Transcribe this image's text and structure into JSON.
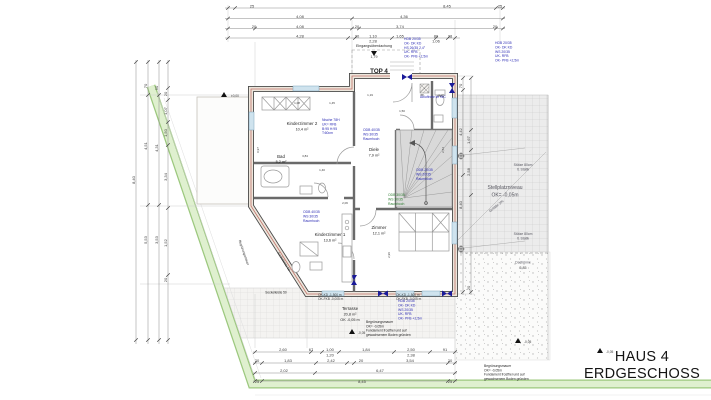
{
  "title_block": {
    "line1": "HAUS 4",
    "line2": "ERDGESCHOSS"
  },
  "colors": {
    "dim": "#3c3c3c",
    "room": "#1f1f1f",
    "muted": "#55555e",
    "blue": "#2b2bb4",
    "green": "#2e7d32",
    "boundary": "#8fbf77",
    "boundary_fill": "#dff0cf",
    "wall": "#4a4a4a",
    "wall_fill": "#ece6dc",
    "wall_accent": "#c0736a",
    "window": "#cfe3ee",
    "marker_blue": "#1a1a99"
  },
  "annotations": {
    "labels": [
      {
        "t": "25",
        "x": 252,
        "y": 7.5
      },
      {
        "t": "8,45",
        "x": 447,
        "y": 7.5
      },
      {
        "t": "25",
        "x": 500,
        "y": 7.5
      },
      {
        "t": "4,08",
        "x": 300,
        "y": 18
      },
      {
        "t": "4,36",
        "x": 404,
        "y": 18
      },
      {
        "t": "20",
        "x": 254,
        "y": 28
      },
      {
        "t": "4,08",
        "x": 300,
        "y": 28
      },
      {
        "t": "20",
        "x": 357,
        "y": 28
      },
      {
        "t": "3,74",
        "x": 400,
        "y": 28
      },
      {
        "t": "20",
        "x": 495,
        "y": 28
      },
      {
        "t": "4,28",
        "x": 300,
        "y": 37.5
      },
      {
        "t": "20",
        "x": 357,
        "y": 37.5
      },
      {
        "t": "1,10",
        "x": 373,
        "y": 37.5
      },
      {
        "t": "1,65",
        "x": 400,
        "y": 37.5
      },
      {
        "t": "80",
        "x": 436,
        "y": 37.5
      },
      {
        "t": "28",
        "x": 450,
        "y": 37.5
      },
      {
        "t": "2,28",
        "x": 373,
        "y": 42.5
      },
      {
        "t": "1,06",
        "x": 436,
        "y": 42.5
      },
      {
        "t": "Eingangsüberdachung",
        "x": 374,
        "y": 47,
        "s": 3.6,
        "c": "room"
      },
      {
        "t": "1,79",
        "x": 374,
        "y": 58,
        "s": 3.6
      },
      {
        "t": "8,40",
        "x": 135,
        "y": 180,
        "r": -90
      },
      {
        "t": "70",
        "x": 147,
        "y": 86,
        "r": -90
      },
      {
        "t": "4,51",
        "x": 147,
        "y": 146,
        "r": -90
      },
      {
        "t": "5,53",
        "x": 147,
        "y": 240,
        "r": -90
      },
      {
        "t": "50",
        "x": 158,
        "y": 88,
        "r": -90
      },
      {
        "t": "4,31",
        "x": 158,
        "y": 148,
        "r": -90
      },
      {
        "t": "3,53",
        "x": 158,
        "y": 240,
        "r": -90
      },
      {
        "t": "20",
        "x": 167,
        "y": 94,
        "r": -90
      },
      {
        "t": "1,07",
        "x": 167,
        "y": 111,
        "r": -90
      },
      {
        "t": "1,50",
        "x": 167,
        "y": 133,
        "r": -90
      },
      {
        "t": "3,34",
        "x": 167,
        "y": 177,
        "r": -90
      },
      {
        "t": "1,52",
        "x": 167,
        "y": 243,
        "r": -90
      },
      {
        "t": "20",
        "x": 167,
        "y": 280,
        "r": -90
      },
      {
        "t": "70",
        "x": 462,
        "y": 86,
        "r": -90
      },
      {
        "t": "4,42",
        "x": 462,
        "y": 132,
        "r": -90
      },
      {
        "t": "8,40",
        "x": 462,
        "y": 205,
        "r": -90
      },
      {
        "t": "1,67",
        "x": 470,
        "y": 140,
        "r": -90
      },
      {
        "t": "2,58",
        "x": 470,
        "y": 172,
        "r": -90
      },
      {
        "t": "20",
        "x": 470,
        "y": 288,
        "r": -90
      },
      {
        "t": "2,60",
        "x": 283,
        "y": 351
      },
      {
        "t": "67",
        "x": 311,
        "y": 351
      },
      {
        "t": "1,00",
        "x": 330,
        "y": 351
      },
      {
        "t": "1,84",
        "x": 366,
        "y": 351
      },
      {
        "t": "2,50",
        "x": 411,
        "y": 351
      },
      {
        "t": "91",
        "x": 445,
        "y": 351
      },
      {
        "t": "1,20",
        "x": 330,
        "y": 356.5
      },
      {
        "t": "2,38",
        "x": 411,
        "y": 356.5
      },
      {
        "t": "20",
        "x": 257,
        "y": 362
      },
      {
        "t": "1,83",
        "x": 288,
        "y": 362
      },
      {
        "t": "2,42",
        "x": 331,
        "y": 362
      },
      {
        "t": "20",
        "x": 361,
        "y": 362
      },
      {
        "t": "3,54",
        "x": 410,
        "y": 362
      },
      {
        "t": "20",
        "x": 450,
        "y": 362
      },
      {
        "t": "2,02",
        "x": 284,
        "y": 372
      },
      {
        "t": "6,47",
        "x": 380,
        "y": 372
      },
      {
        "t": "25",
        "x": 257,
        "y": 383
      },
      {
        "t": "8,45",
        "x": 362,
        "y": 383
      },
      {
        "t": "25",
        "x": 450,
        "y": 383
      },
      {
        "t": "5,85",
        "x": 523,
        "y": 269,
        "s": 3.6
      },
      {
        "t": "TOP 4",
        "x": 379,
        "y": 73,
        "s": 6.2,
        "b": 1,
        "c": "room"
      },
      {
        "t": "Kinderzimmer 2",
        "x": 302,
        "y": 125,
        "s": 4.4,
        "c": "room"
      },
      {
        "t": "10,4 m²",
        "x": 302,
        "y": 130.5,
        "s": 3.8,
        "c": "room"
      },
      {
        "t": "Bad",
        "x": 281,
        "y": 158,
        "s": 4.4,
        "c": "room"
      },
      {
        "t": "5,2 m²",
        "x": 281,
        "y": 163,
        "s": 3.8,
        "c": "room"
      },
      {
        "t": "Kinderzimmer 1",
        "x": 330,
        "y": 236,
        "s": 4.4,
        "c": "room"
      },
      {
        "t": "13,6 m²",
        "x": 330,
        "y": 241.5,
        "s": 3.8,
        "c": "room"
      },
      {
        "t": "Diele",
        "x": 374,
        "y": 151,
        "s": 4.4,
        "c": "room"
      },
      {
        "t": "7,9 m²",
        "x": 374,
        "y": 156.5,
        "s": 3.8,
        "c": "room"
      },
      {
        "t": "Zimmer",
        "x": 379,
        "y": 229,
        "s": 4.4,
        "c": "room"
      },
      {
        "t": "12,1 m²",
        "x": 379,
        "y": 234.5,
        "s": 3.8,
        "c": "room"
      },
      {
        "t": "WC",
        "x": 441,
        "y": 97,
        "s": 3.8,
        "c": "room"
      },
      {
        "t": "Terrasse",
        "x": 350,
        "y": 310,
        "s": 4.2,
        "c": "room"
      },
      {
        "t": "20,8 m²",
        "x": 350,
        "y": 315.5,
        "s": 3.8,
        "c": "room"
      },
      {
        "t": "OK -0,05 m",
        "x": 350,
        "y": 321,
        "s": 3.8,
        "c": "room"
      },
      {
        "t": "Stellplatzniveau",
        "x": 505,
        "y": 189,
        "s": 5,
        "c": "muted"
      },
      {
        "t": "OK= -0,05m",
        "x": 505,
        "y": 196.5,
        "s": 5,
        "c": "muted"
      },
      {
        "t": "Stütze 80cm",
        "x": 523,
        "y": 166,
        "s": 3.4,
        "c": "muted"
      },
      {
        "t": "lt. Statik",
        "x": 523,
        "y": 170.5,
        "s": 3.4,
        "c": "muted"
      },
      {
        "t": "Stütze 80cm",
        "x": 523,
        "y": 235,
        "s": 3.4,
        "c": "muted"
      },
      {
        "t": "lt. Statik",
        "x": 523,
        "y": 239.5,
        "s": 3.4,
        "c": "muted"
      },
      {
        "t": "Dachrinne",
        "x": 523,
        "y": 263.5,
        "s": 3.4,
        "c": "muted"
      },
      {
        "t": "Gefälle 2%",
        "x": 497,
        "y": 207,
        "s": 3.6,
        "r": -38,
        "c": "muted"
      },
      {
        "t": "Sockelleiste 50",
        "x": 276,
        "y": 293.5,
        "s": 3.2,
        "c": "room"
      },
      {
        "t": "Sockelleiste 50",
        "x": 283,
        "y": 262,
        "s": 3.2,
        "r": 58,
        "c": "room"
      },
      {
        "t": "Begrünungsmauer",
        "x": 243,
        "y": 253,
        "s": 3.2,
        "r": 71,
        "c": "room"
      },
      {
        "t": "±0,00",
        "x": 231,
        "y": 97,
        "s": 3.2,
        "a": "start"
      },
      {
        "t": "-0,05",
        "x": 358,
        "y": 334,
        "s": 3.2,
        "a": "start"
      },
      {
        "t": "-0,05",
        "x": 524,
        "y": 343,
        "s": 3.2,
        "a": "start"
      },
      {
        "t": "-0,05",
        "x": 606,
        "y": 353,
        "s": 3.2,
        "a": "start"
      },
      {
        "t": "1,08",
        "x": 297,
        "y": 104,
        "s": 3
      },
      {
        "t": "1,45",
        "x": 332,
        "y": 104,
        "s": 3
      },
      {
        "t": "3,84",
        "x": 305,
        "y": 157,
        "s": 3
      },
      {
        "t": "1,40",
        "x": 322,
        "y": 171,
        "s": 3
      },
      {
        "t": "2,06",
        "x": 345,
        "y": 204,
        "s": 3
      },
      {
        "t": "0,97",
        "x": 259,
        "y": 150,
        "s": 3,
        "r": -90
      },
      {
        "t": "1,50",
        "x": 402,
        "y": 112,
        "s": 3
      },
      {
        "t": "2,54",
        "x": 444,
        "y": 150,
        "s": 3,
        "r": -90
      },
      {
        "t": "1,19",
        "x": 370,
        "y": 96,
        "s": 3
      },
      {
        "t": "88",
        "x": 422,
        "y": 96,
        "s": 3
      },
      {
        "t": "2,96",
        "x": 390,
        "y": 255,
        "s": 3,
        "r": -90
      }
    ],
    "blocks": [
      {
        "x": 404,
        "y": 40,
        "c": "blue",
        "lines": [
          "HDB 20/35",
          "OK- DK KD",
          "HS 26/35 2,4°",
          "UK- RFB",
          "OK- PFB +2,5m"
        ]
      },
      {
        "x": 495,
        "y": 44,
        "c": "blue",
        "lines": [
          "HDB 20/35",
          "OK- DK KD",
          "WS 20/35",
          "UK- RFB",
          "OK- PFB +2,5m"
        ]
      },
      {
        "x": 363,
        "y": 131,
        "c": "blue",
        "lines": [
          "ODB 40/35",
          "WS 30/35",
          "Raumhoch"
        ]
      },
      {
        "x": 416,
        "y": 171,
        "c": "blue",
        "lines": [
          "ODB 20/35",
          "WS 20/35",
          "Raumhoch"
        ]
      },
      {
        "x": 322,
        "y": 121,
        "c": "blue",
        "lines": [
          "Nische 78H",
          "UK= RFB",
          "B:95 H:95",
          "T:60cm"
        ]
      },
      {
        "x": 303,
        "y": 213,
        "c": "blue",
        "lines": [
          "ODB 40/35",
          "WS 30/35",
          "Raumhoch"
        ]
      },
      {
        "x": 398,
        "y": 302,
        "c": "blue",
        "lines": [
          "HDB 20/35",
          "OK- DK KD",
          "WS 20/35",
          "UK- RFB",
          "OK- PFB +2,5m"
        ]
      },
      {
        "x": 420,
        "y": 98,
        "c": "blue",
        "lines": [
          "Abluftrohr im WC"
        ]
      },
      {
        "x": 388,
        "y": 196,
        "c": "green",
        "lines": [
          "ODB 30/35",
          "WS 30/35",
          "Raumhoch"
        ]
      },
      {
        "x": 366,
        "y": 323,
        "c": "room",
        "s": 3.3,
        "lines": [
          "Begrünungsmauer",
          "OK= -0,05m",
          "Fundament frostfrei und auf",
          "gewachsenem Boden gründen"
        ]
      },
      {
        "x": 484,
        "y": 367,
        "c": "room",
        "s": 3.3,
        "lines": [
          "Begrünungsmauer",
          "OK= -0,05m",
          "Fundament frostfrei und auf",
          "gewachsenem Boden gründen"
        ]
      },
      {
        "x": 318,
        "y": 296,
        "c": "dim",
        "s": 3.2,
        "lines": [
          "OK-KD  -1,500 m",
          "OK-FKB -0,005 m"
        ]
      },
      {
        "x": 396,
        "y": 296,
        "c": "dim",
        "s": 3.2,
        "lines": [
          "OK-KD  -1,500 m",
          "OK-FKB -0,005 m"
        ]
      }
    ]
  }
}
